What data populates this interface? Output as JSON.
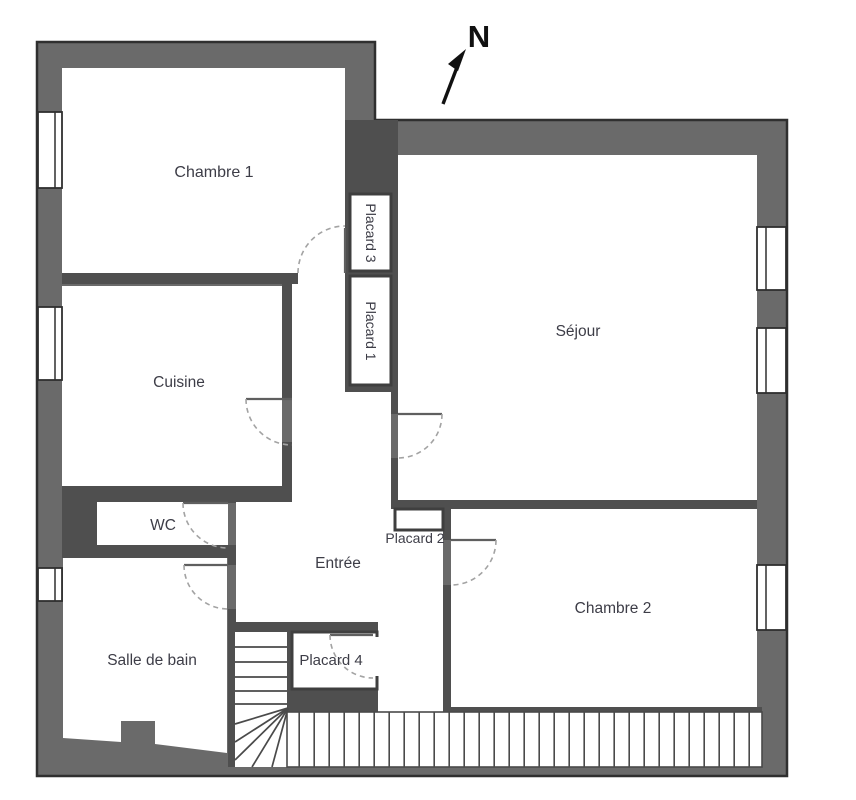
{
  "title": "floor-plan",
  "compass": {
    "label": "N"
  },
  "rooms": {
    "chambre1": "Chambre 1",
    "cuisine": "Cuisine",
    "wc": "WC",
    "salle_de_bain": "Salle de bain",
    "entree": "Entrée",
    "sejour": "Séjour",
    "chambre2": "Chambre 2",
    "placard1": "Placard 1",
    "placard2": "Placard 2",
    "placard3": "Placard 3",
    "placard4": "Placard 4"
  },
  "colors": {
    "outer_wall": "#6a6a6a",
    "inner_wall": "#4f4f4f",
    "room_fill": "#ffffff",
    "label_text": "#3d3d47",
    "door_arc": "#a3a3a3"
  }
}
